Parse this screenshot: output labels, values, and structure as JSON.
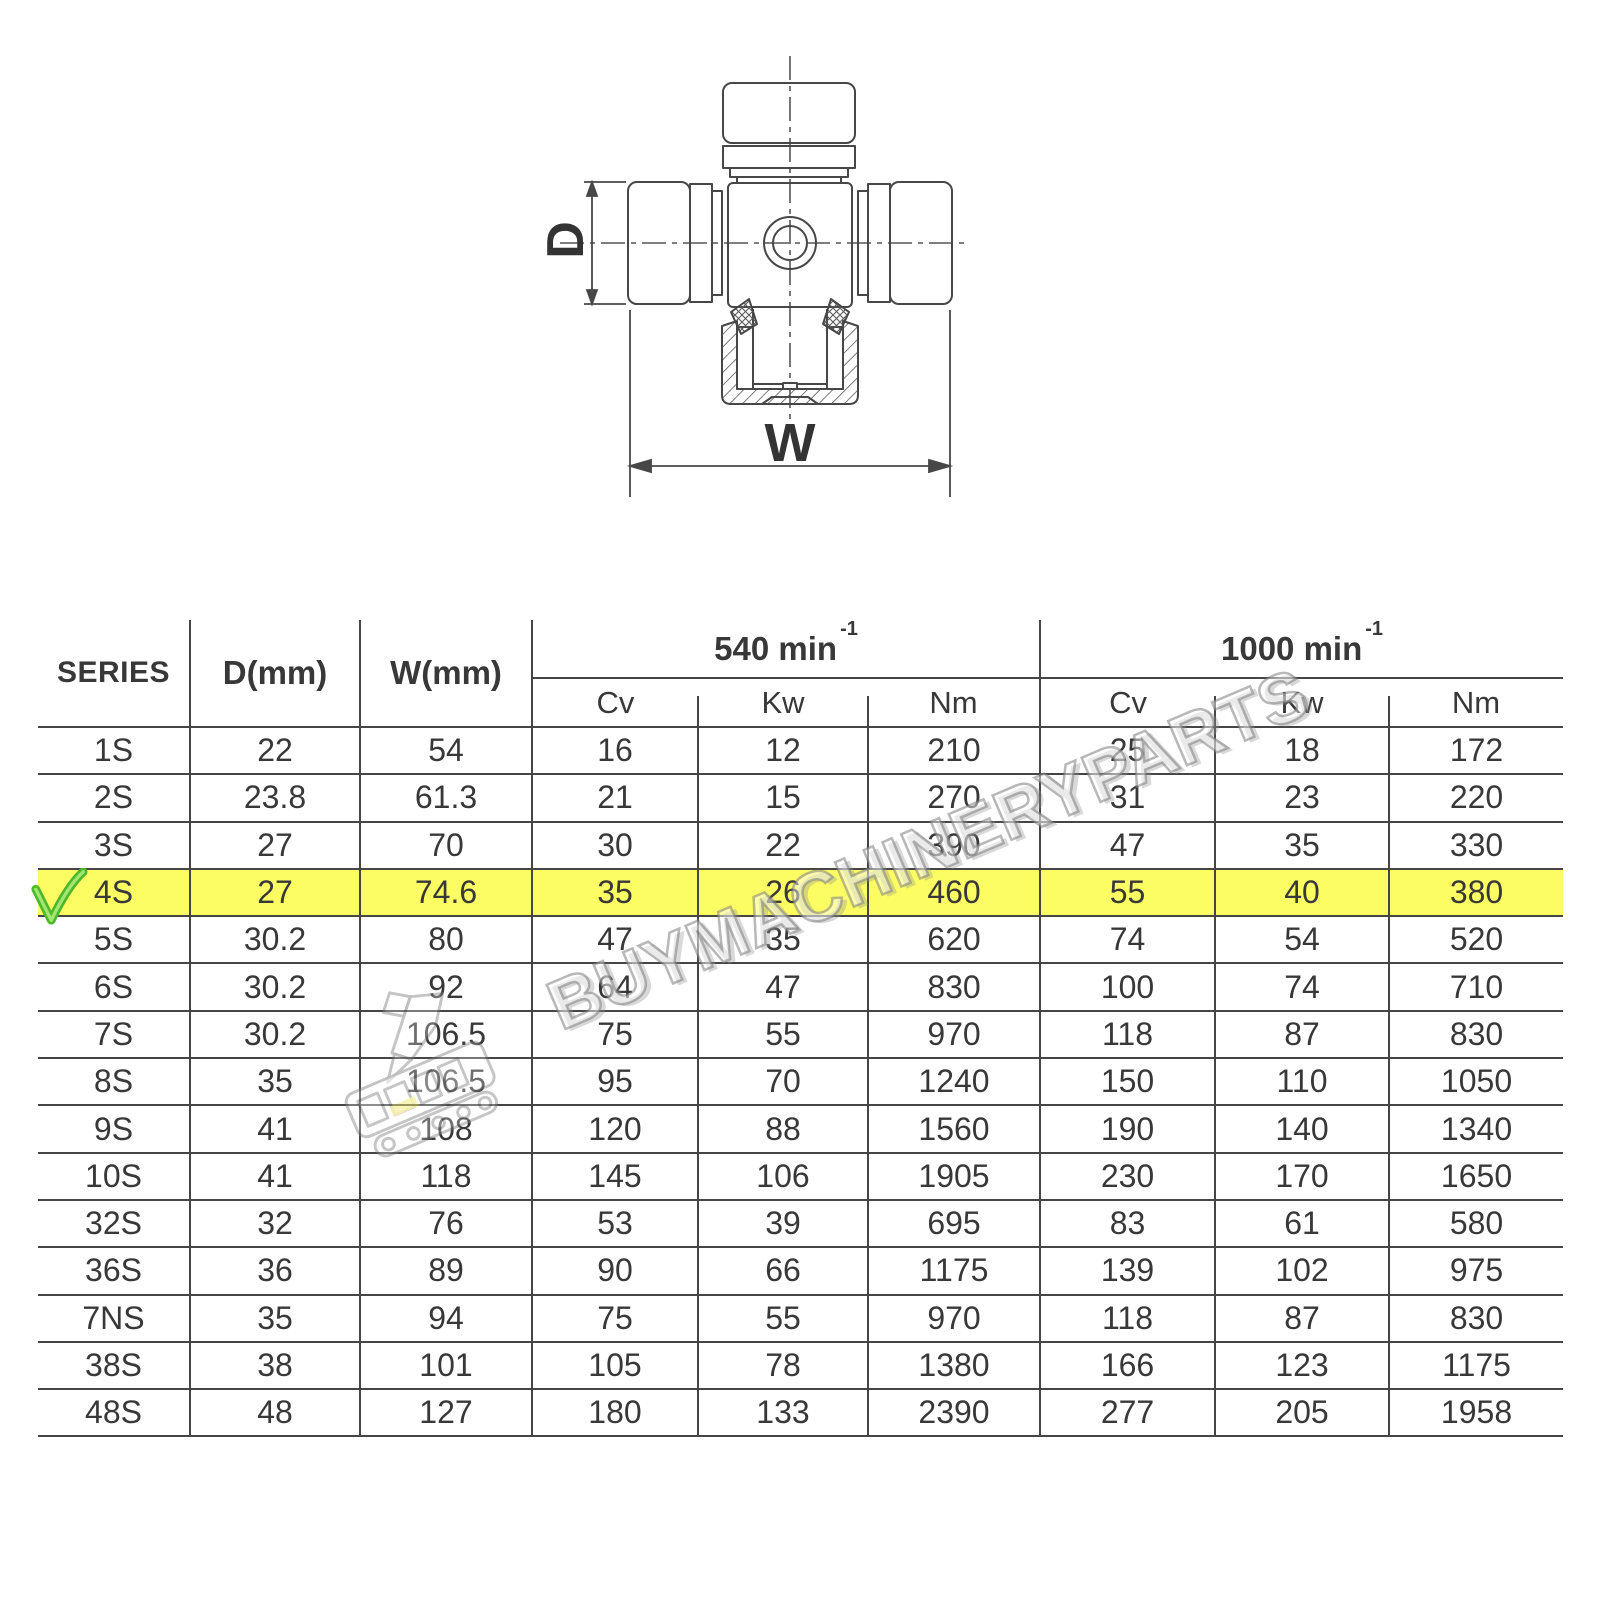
{
  "diagram": {
    "d_label": "D",
    "w_label": "W"
  },
  "watermark": {
    "text": "BUYMACHINERYPARTS"
  },
  "table": {
    "highlight_color": "#fcfc63",
    "headers": {
      "series": "SERIES",
      "d": "D(mm)",
      "w": "W(mm)",
      "speed_groups": [
        {
          "label": "540 min",
          "sup": "-1"
        },
        {
          "label": "1000 min",
          "sup": "-1"
        }
      ],
      "sub_columns": [
        "Cv",
        "Kw",
        "Nm",
        "Cv",
        "Kw",
        "Nm"
      ]
    },
    "rows": [
      {
        "series": "1S",
        "cells": [
          "22",
          "54",
          "16",
          "12",
          "210",
          "25",
          "18",
          "172"
        ],
        "highlight": false,
        "check": false
      },
      {
        "series": "2S",
        "cells": [
          "23.8",
          "61.3",
          "21",
          "15",
          "270",
          "31",
          "23",
          "220"
        ],
        "highlight": false,
        "check": false
      },
      {
        "series": "3S",
        "cells": [
          "27",
          "70",
          "30",
          "22",
          "390",
          "47",
          "35",
          "330"
        ],
        "highlight": false,
        "check": false
      },
      {
        "series": "4S",
        "cells": [
          "27",
          "74.6",
          "35",
          "26",
          "460",
          "55",
          "40",
          "380"
        ],
        "highlight": true,
        "check": true
      },
      {
        "series": "5S",
        "cells": [
          "30.2",
          "80",
          "47",
          "35",
          "620",
          "74",
          "54",
          "520"
        ],
        "highlight": false,
        "check": false
      },
      {
        "series": "6S",
        "cells": [
          "30.2",
          "92",
          "64",
          "47",
          "830",
          "100",
          "74",
          "710"
        ],
        "highlight": false,
        "check": false
      },
      {
        "series": "7S",
        "cells": [
          "30.2",
          "106.5",
          "75",
          "55",
          "970",
          "118",
          "87",
          "830"
        ],
        "highlight": false,
        "check": false
      },
      {
        "series": "8S",
        "cells": [
          "35",
          "106.5",
          "95",
          "70",
          "1240",
          "150",
          "110",
          "1050"
        ],
        "highlight": false,
        "check": false
      },
      {
        "series": "9S",
        "cells": [
          "41",
          "108",
          "120",
          "88",
          "1560",
          "190",
          "140",
          "1340"
        ],
        "highlight": false,
        "check": false
      },
      {
        "series": "10S",
        "cells": [
          "41",
          "118",
          "145",
          "106",
          "1905",
          "230",
          "170",
          "1650"
        ],
        "highlight": false,
        "check": false
      },
      {
        "series": "32S",
        "cells": [
          "32",
          "76",
          "53",
          "39",
          "695",
          "83",
          "61",
          "580"
        ],
        "highlight": false,
        "check": false
      },
      {
        "series": "36S",
        "cells": [
          "36",
          "89",
          "90",
          "66",
          "1175",
          "139",
          "102",
          "975"
        ],
        "highlight": false,
        "check": false
      },
      {
        "series": "7NS",
        "cells": [
          "35",
          "94",
          "75",
          "55",
          "970",
          "118",
          "87",
          "830"
        ],
        "highlight": false,
        "check": false
      },
      {
        "series": "38S",
        "cells": [
          "38",
          "101",
          "105",
          "78",
          "1380",
          "166",
          "123",
          "1175"
        ],
        "highlight": false,
        "check": false
      },
      {
        "series": "48S",
        "cells": [
          "48",
          "127",
          "180",
          "133",
          "2390",
          "277",
          "205",
          "1958"
        ],
        "highlight": false,
        "check": false
      }
    ]
  }
}
